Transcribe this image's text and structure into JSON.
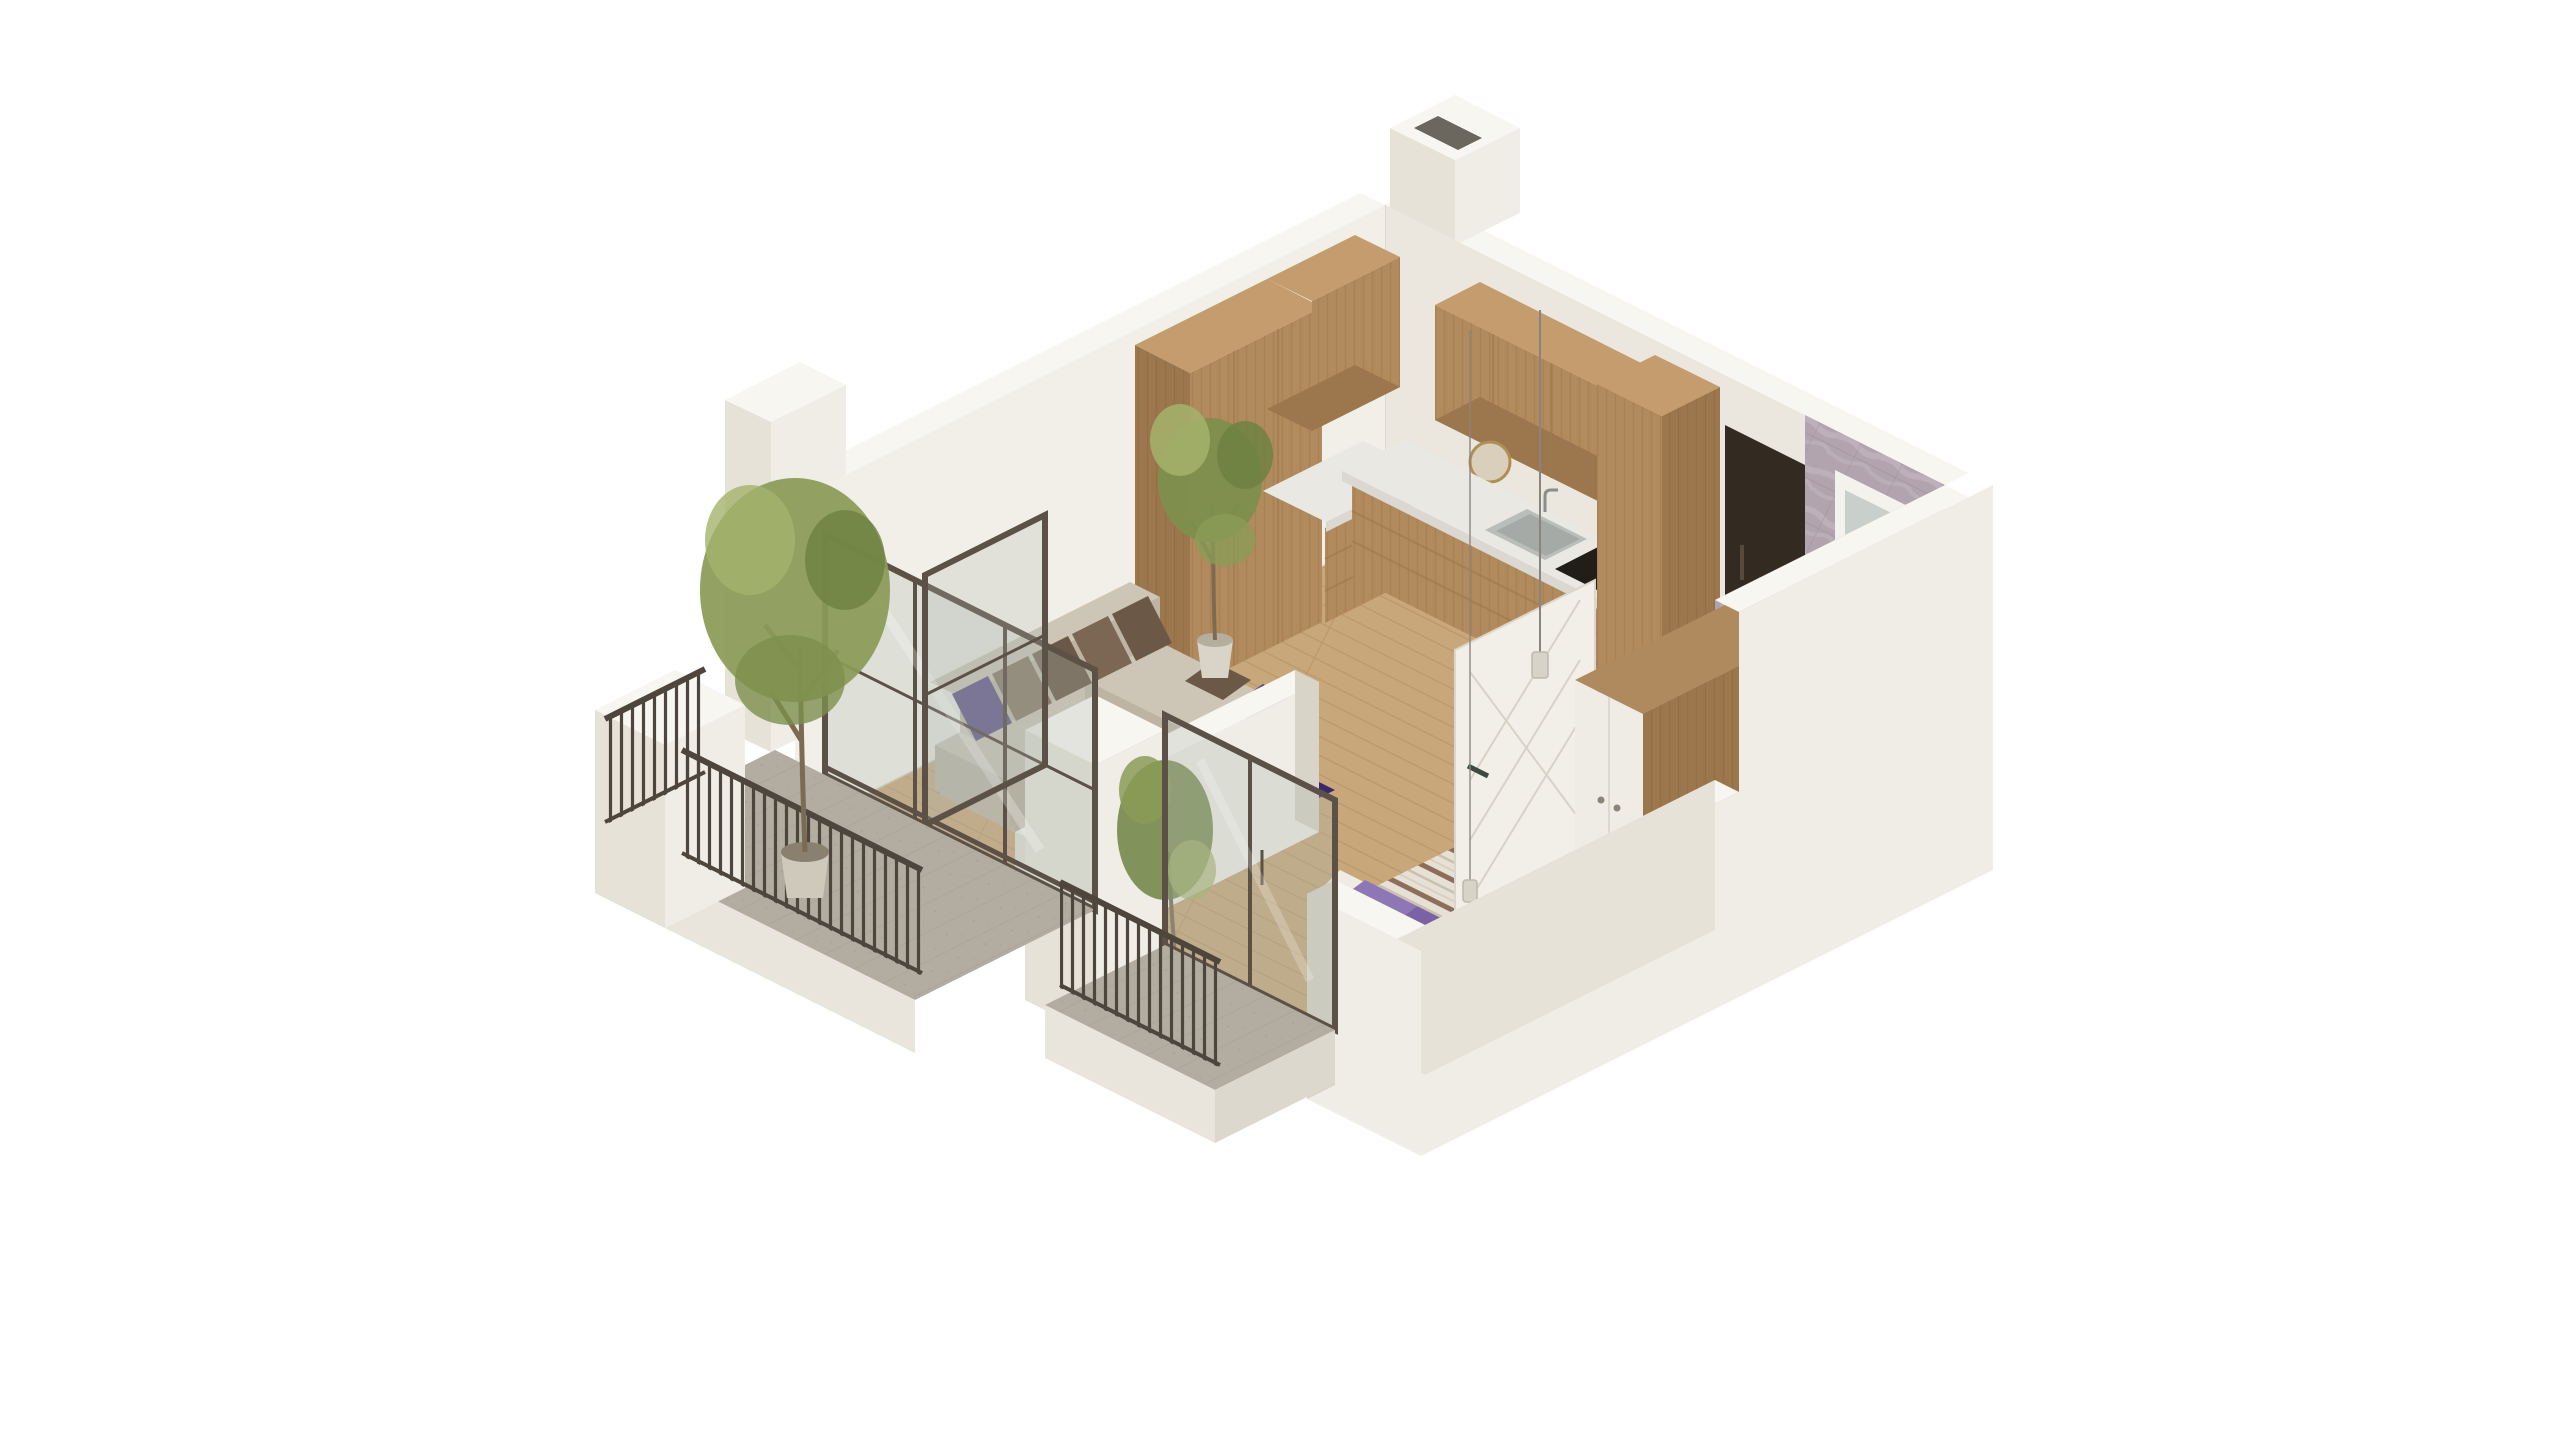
{
  "meta": {
    "title": "isometric-apartment-floorplan-render",
    "background": "#ffffff",
    "view": "isometric cutaway, walls sliced, viewed from south-west above"
  },
  "colors": {
    "wall_lit": "#f0ede6",
    "wall_shade": "#e6e2d8",
    "wall_top": "#f8f6f1",
    "wall_inner_ne": "#ebe7de",
    "wall_inner_nw": "#f2efe9",
    "wall_inner_sw": "#e7e2d7",
    "wall_dark": "#d9d4c8",
    "slab": "#e9e5dc",
    "slab_side": "#ddd8cd",
    "floor_wood": "#c8a77b",
    "plank_line": "#b9976b",
    "floor_balcony": "#b2aca1",
    "balcony_line": "#a5a094",
    "floor_bath": "#94a7a5",
    "bath_line": "#85999a",
    "marble": "#b1a4ae",
    "marble_vein": "#c6bac3",
    "marble_line": "#9c8f99",
    "wood": "#b18a5d",
    "wood_grain": "#a07a4e",
    "wood_dark": "#9c764c",
    "wood_top": "#c49c6e",
    "counter": "#eae8e2",
    "counter_edge": "#dbd8d1",
    "niche": "#332a21",
    "glass_frame": "#5b5146",
    "glass": "#aeb8ae",
    "railing": "#4e463c",
    "sofa": "#cdc5b6",
    "sofa_shade": "#bdb4a4",
    "sofa_side": "#b7ae9e",
    "cushion_brown": "#6b5847",
    "cushion_brown2": "#7c6754",
    "cushion_purple": "#4c3a80",
    "chaise_purple": "#553f8a",
    "rug": "#39296b",
    "table_top": "#edebe7",
    "table_front": "#dfdcd6",
    "table_side": "#d7d4cd",
    "duvet": "#e7e0d4",
    "duvet_stripe": "#8d6f59",
    "duvet_stripe2": "#cbbfae",
    "mattress": "#ddd5c6",
    "pillow_purple": "#8e77b5",
    "pillow_purple_dark": "#7a63a4",
    "pillow_white": "#efece4",
    "wardrobe_wood": "#a07c52",
    "wardrobe_top": "#b08a5f",
    "wardrobe_front": "#efece6",
    "door_white": "#f2efe9",
    "door_line": "#d8d2c6",
    "door_handle": "#3c4a42",
    "fixture": "#f2f1ed",
    "fixture_shade": "#dddad2",
    "hob": "#211e1a",
    "steel": "#b9beba",
    "steel_dark": "#a5aaa6",
    "pot_white": "#dad4c8",
    "planter": "#cfc9bb",
    "soil": "#8a8070",
    "trunk": "#7b6b52",
    "foliage1": "#8b9b57",
    "foliage2": "#a4b36b",
    "foliage3": "#6f8142",
    "foliage4": "#7d8f4d",
    "pendant_cord": "#8a857c",
    "pendant": "#d8d3c8",
    "window_frame": "#f4f2ed",
    "window_glass": "#c9cfcb"
  },
  "scene": {
    "rooms": [
      {
        "id": "kitchen",
        "position": "far north corner",
        "elements": [
          "tall-wood-cabinets",
          "upper-wood-cabinets",
          "base-wood-cabinets",
          "white-countertop",
          "steel-sink",
          "faucet",
          "black-cooktop",
          "decor-plate",
          "coffee-machine"
        ]
      },
      {
        "id": "living-room",
        "position": "west",
        "elements": [
          "l-shaped-sofa",
          "brown-back-cushions",
          "purple-accent-cushions",
          "chaise",
          "dark-purple-rug",
          "marble-coffee-table",
          "potted-ficus-tree"
        ]
      },
      {
        "id": "bedroom",
        "position": "south-east",
        "elements": [
          "double-bed",
          "striped-duvet",
          "purple-pillows",
          "white-pillow",
          "pendant-lamps"
        ]
      },
      {
        "id": "hallway",
        "position": "center-east",
        "elements": [
          "dark-entry-niche",
          "white-paneled-door",
          "wardrobe-wood-white"
        ]
      },
      {
        "id": "bathroom",
        "position": "east corner",
        "elements": [
          "marble-clad-walls",
          "teal-tile-floor",
          "vanity-sink",
          "toilet",
          "walk-in-shower-glass",
          "shower-head",
          "window"
        ]
      },
      {
        "id": "balcony-main",
        "position": "south-west",
        "elements": [
          "stone-floor",
          "metal-bar-railing",
          "white-parapet-piers",
          "tree-in-planter"
        ]
      },
      {
        "id": "balcony-bedroom",
        "position": "south",
        "elements": [
          "stone-floor",
          "metal-bar-railing"
        ]
      }
    ],
    "glazing": [
      "living-room-glass-doors",
      "open-glass-door-leaf",
      "bedroom-sliding-glass-door"
    ],
    "structure": [
      "vent-shaft-chimney",
      "nw-facade-pier",
      "cut-away-front-walls"
    ]
  }
}
